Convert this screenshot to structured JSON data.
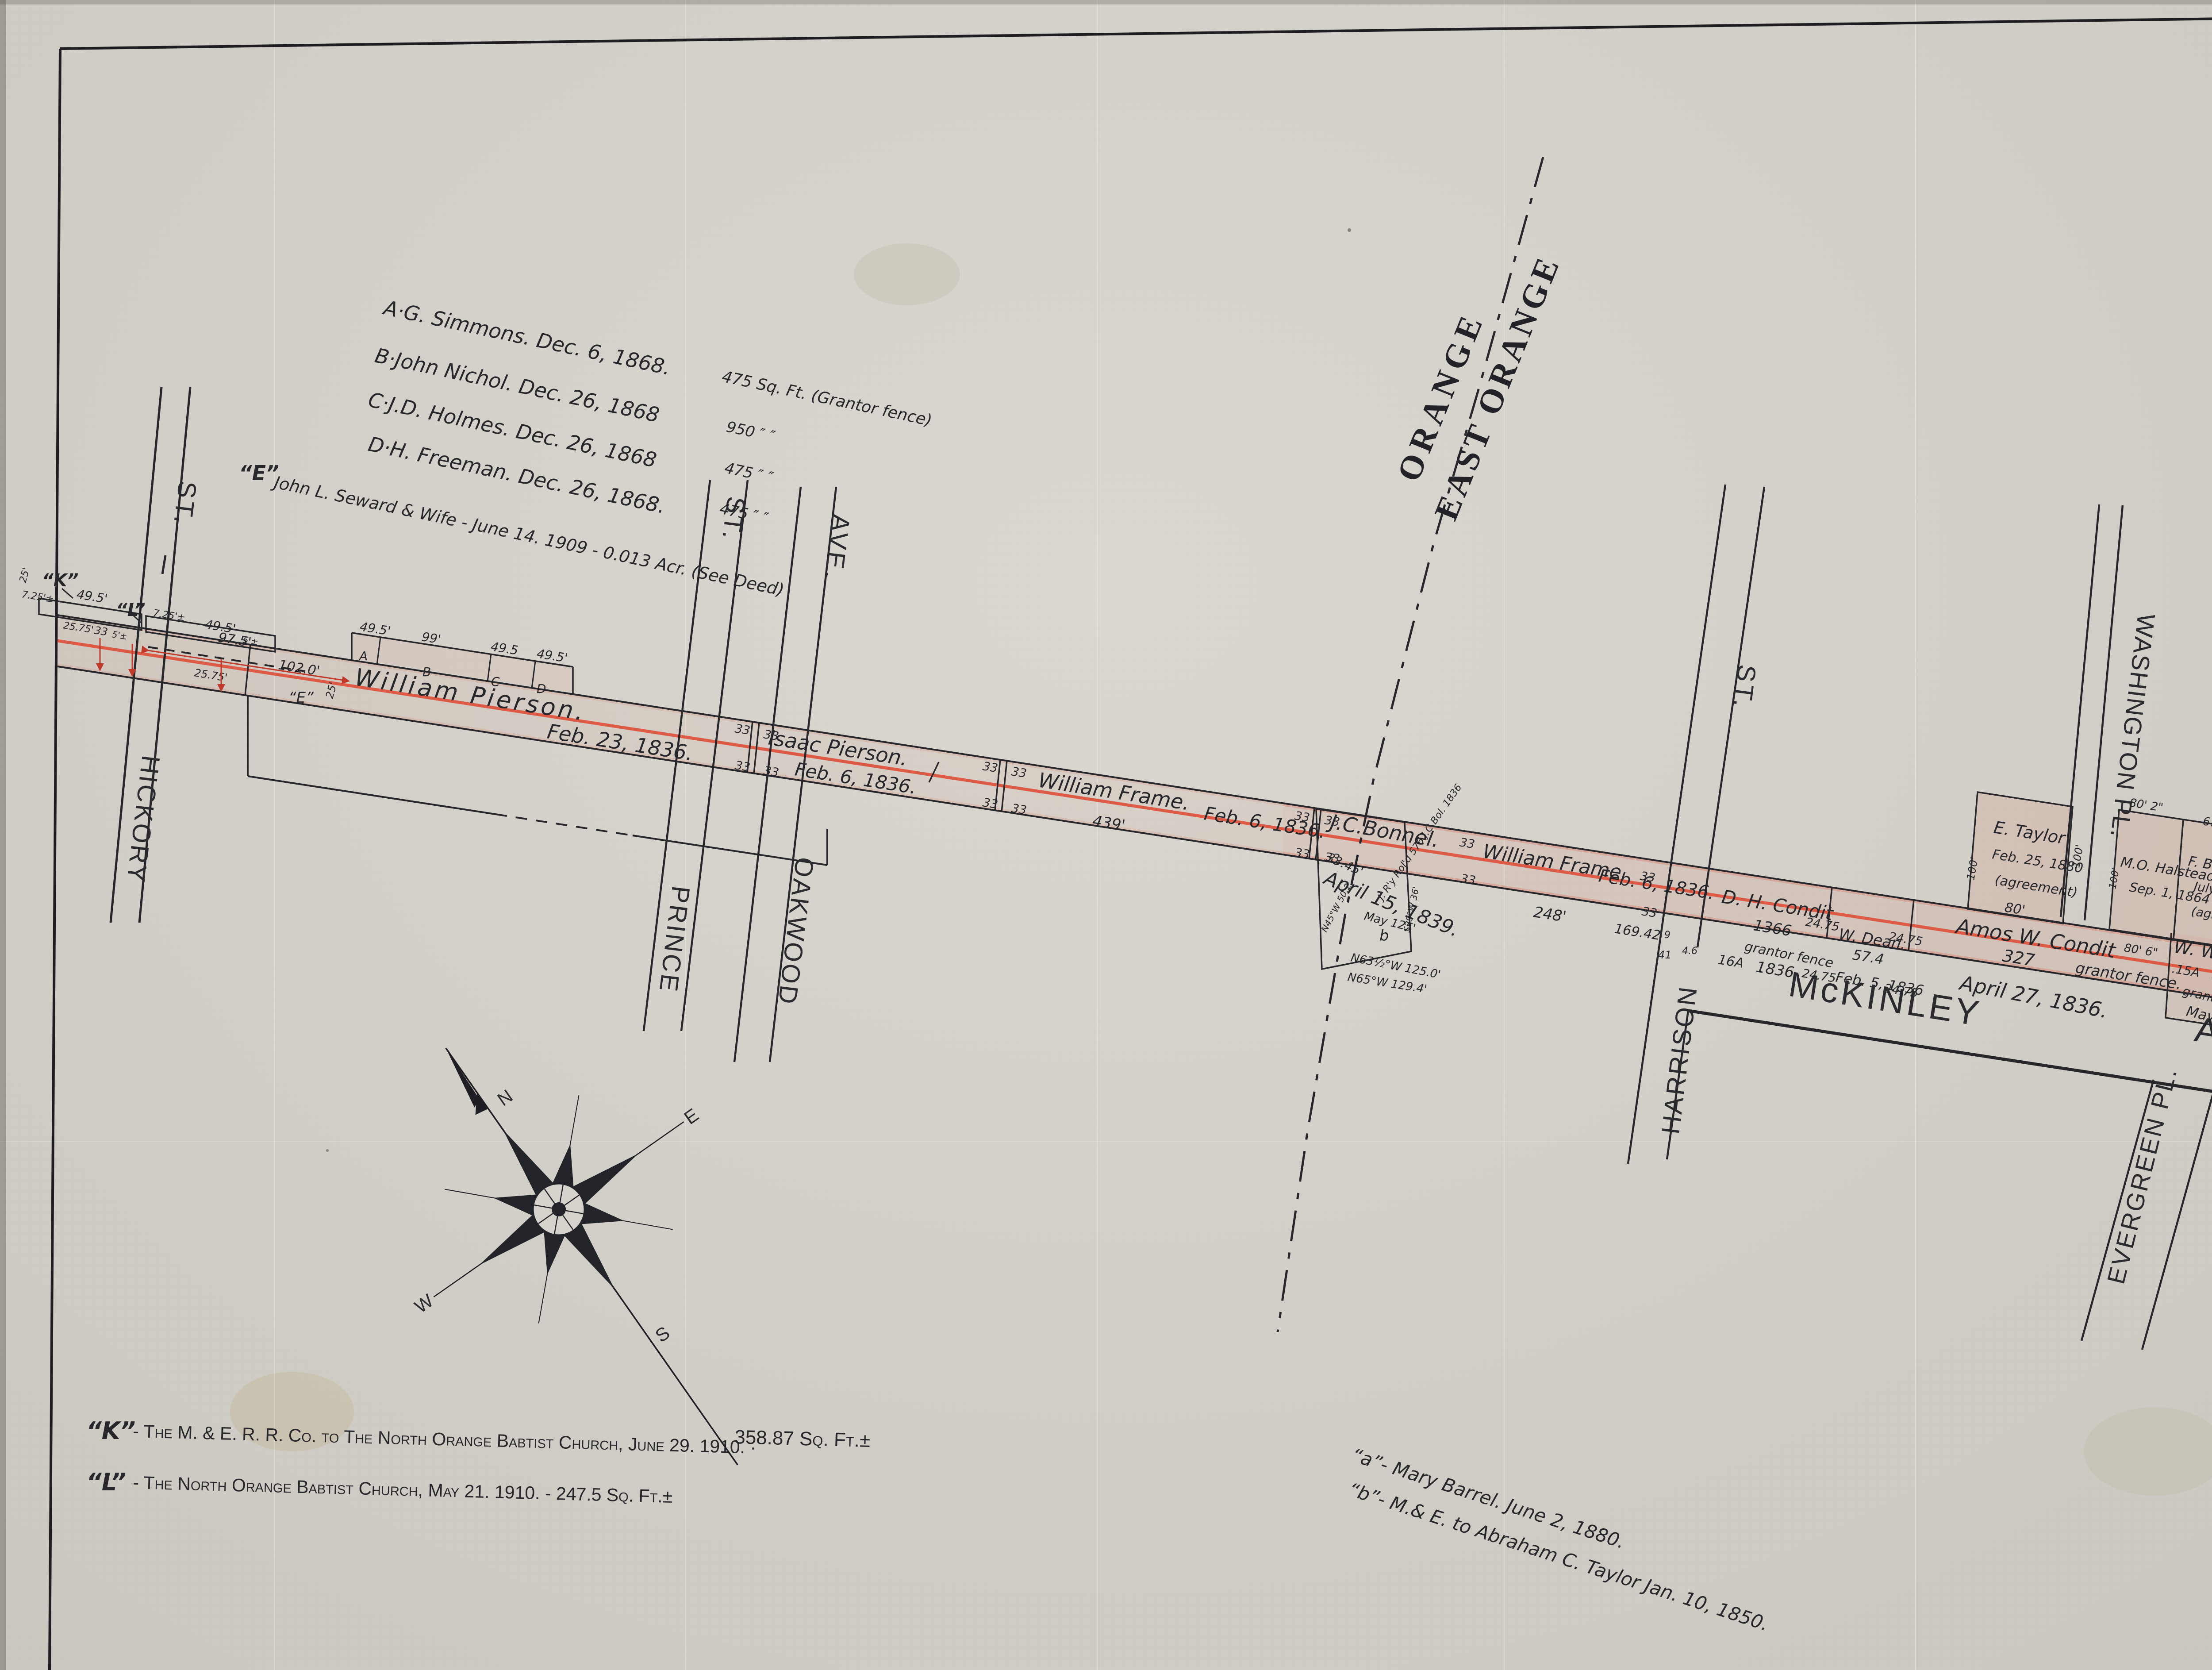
{
  "sheet": {
    "number": "23"
  },
  "boundary": {
    "orange": "ORANGE",
    "east_orange": "EAST ORANGE"
  },
  "streets": {
    "hickory": "HICKORY",
    "hickory_sfx": "ST.",
    "prince": "PRINCE",
    "prince_sfx": "ST.",
    "oakwood": "OAKWOOD",
    "oakwood_sfx": "AVE.",
    "harrison": "HARRISON",
    "harrison_sfx": "ST.",
    "washington": "WASHINGTON PL.",
    "prospect": "PROSPECT PL.",
    "evergreen": "EVERGREEN PL.",
    "mckinley": "McKINLEY",
    "mckinley_sfx": "AVE."
  },
  "deed_list": {
    "rows": [
      {
        "label": "A·G. Simmons. Dec. 6, 1868.",
        "value": "475 Sq. Ft. (Grantor fence)"
      },
      {
        "label": "B·John Nichol. Dec. 26, 1868",
        "value": "950  ″    ″"
      },
      {
        "label": "C·J.D. Holmes. Dec. 26, 1868",
        "value": "475  ″    ″"
      },
      {
        "label": "D·H. Freeman. Dec. 26, 1868.",
        "value": "475  ″    ″"
      }
    ],
    "e_mark": "“E”",
    "e_text": "John L. Seward & Wife - June 14. 1909 - 0.013 Acr. (See Deed)"
  },
  "parcels": {
    "william_pierson": "William  Pierson.",
    "wp_date": "Feb. 23, 1836.",
    "isaac_pierson": "Isaac Pierson.",
    "ip_date": "Feb. 6, 1836.",
    "frame": "William Frame.",
    "frame_date": "Feb. 6, 1836.",
    "bonnel": "J.C.Bonnel.",
    "bonnel_date": "April 15, 1839.",
    "bonnel_note": "J. R'y Rol'd 576 J.C.Bol. 1836",
    "dh_condit": "D. H. Condit",
    "dh_date": "1836.",
    "dh_area": "16A",
    "dean": "W. Dean.",
    "dean_len": "57.4",
    "dean_date": "Feb. 5, 1836",
    "amos": "Amos W. Condit",
    "amos_len": "327",
    "amos_date": "April 27, 1836.",
    "taylor": "E. Taylor",
    "taylor_date": "Feb. 25, 1880",
    "agreement": "(agreement)",
    "halstead": "M.O. Halstead",
    "halstead_date": "Sep. 1, 1864",
    "baldwin": "F. Baldwin.",
    "baldwin_date": "July 6, 1880.",
    "williams": "W. Williams",
    "williams_area": ".15A",
    "williams_len": "136.6",
    "williams_date": "May 23, 1836.",
    "bethuel": "Bethuel D. Harrison et al",
    "bethuel_len": "275.2",
    "bethuel_date": "Feb. 9, 1836.",
    "grantor_fence": "grantor fence",
    "grantor_fence_p": "grantor fence."
  },
  "dims": {
    "ft33": "33",
    "ft2475": "24.75",
    "ft2575": "25.75'",
    "ft495": "49.5'",
    "ft495s": "49.5",
    "ft99": "99'",
    "ft725": "7.25'±",
    "ft5": "5'±",
    "ft975": "97.5'",
    "ft1020": "102.0'",
    "ft25": "25'",
    "ft439": "439'",
    "ft248": "248'",
    "ft16942": "169.42",
    "ft1366": "1366",
    "ft80": "80'",
    "ft80_2": "80' 2\"",
    "ft80_6": "80' 6\"",
    "ft100": "100'",
    "ft67": "67",
    "ft574": "57.4",
    "ft3345": "33.45'",
    "may125": "May 125'",
    "n63": "N63½°W 125.0'",
    "n65": "N65°W 129.4'",
    "n45": "N45°W 50.2'",
    "s29": "S29°W 36'",
    "b_mark": "b",
    "ft9": "9",
    "ft41": "41",
    "ft46": "4.6"
  },
  "lots": {
    "a": "A",
    "b": "B",
    "c": "C",
    "d": "D",
    "k": "“K”",
    "l": "“L”"
  },
  "legend": {
    "k_mark": "“K”",
    "k_text": "- The M. & E. R. R. Co. to The North Orange Babtist Church, June 29. 1910.  ·",
    "k_value": "358.87 Sq. Ft.±",
    "l_mark": "“L”",
    "l_text": "- The North Orange Babtist Church, May 21. 1910. - 247.5 Sq. Ft.±"
  },
  "notes": {
    "a": "“a”- Mary Barrel. June 2, 1880.",
    "b": "“b”- M.& E. to Abraham C. Taylor Jan. 10, 1850."
  },
  "compass": {
    "n": "N",
    "e": "E",
    "s": "S",
    "w": "W"
  },
  "colors": {
    "paper": "#d5d3cb",
    "ink": "#26262b",
    "rail": "#de5540",
    "dim_red": "#c0392b"
  }
}
